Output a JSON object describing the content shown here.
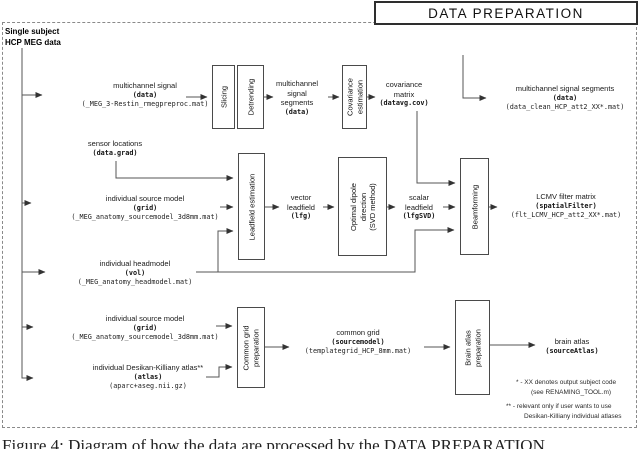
{
  "title": "DATA PREPARATION",
  "subject_label": "Single subject\nHCP MEG data",
  "caption": "Figure 4: Diagram of how the data are processed by the DATA PREPARATION",
  "boxes": {
    "slicing": "Slicing",
    "detrending": "Detrending",
    "covariance_estimation": "Covariance\nestimation",
    "leadfield_estimation": "Leadfield estimation",
    "optimal_dipole": "Optimal dipole\ndirection\n(SVD method)",
    "beamforming": "Beamforming",
    "common_grid_preparation": "Common grid\npreparation",
    "brain_atlas_preparation": "Brain atlas\npreparation"
  },
  "labels": {
    "multichannel_signal": [
      "multichannel signal",
      "(data)",
      "(_MEG_3-Restin_rmegpreproc.mat)"
    ],
    "mc_signal_segments": [
      "multichannel",
      "signal",
      "segments",
      "(data)"
    ],
    "covariance_matrix": [
      "covariance",
      "matrix",
      "(datavg.cov)"
    ],
    "mc_signal_segments_out": [
      "multichannel signal segments",
      "(data)",
      "(data_clean_HCP_att2_XX*.mat)"
    ],
    "sensor_locations": [
      "sensor locations",
      "(data.grad)"
    ],
    "source_model_1": [
      "individual source model",
      "(grid)",
      "(_MEG_anatomy_sourcemodel_3d8mm.mat)"
    ],
    "vector_leadfield": [
      "vector",
      "leadfield",
      "(lfg)"
    ],
    "scalar_leadfield": [
      "scalar",
      "leadfield",
      "(lfgSVD)"
    ],
    "lcmv_filter": [
      "LCMV filter matrix",
      "(spatialFilter)",
      "(flt_LCMV_HCP_att2_XX*.mat)"
    ],
    "headmodel": [
      "individual headmodel",
      "(vol)",
      "(_MEG_anatomy_headmodel.mat)"
    ],
    "source_model_2": [
      "individual source model",
      "(grid)",
      "(_MEG_anatomy_sourcemodel_3d8mm.mat)"
    ],
    "atlas_in": [
      "individual Desikan-Killiany atlas**",
      "(atlas)",
      "(aparc+aseg.nii.gz)"
    ],
    "common_grid_out": [
      "common grid",
      "(sourcemodel)",
      "(templategrid_HCP_8mm.mat)"
    ],
    "brain_atlas_out": [
      "brain atlas",
      "(sourceAtlas)"
    ]
  },
  "footnotes": {
    "f1_line1": "* - XX denotes output subject code",
    "f1_line2": "(see RENAMING_TOOL.m)",
    "f2_line1": "** - relevant only if user wants to use",
    "f2_line2": "Desikan-Killiany individual atlases"
  },
  "colors": {
    "line": "#555555",
    "border": "#8a8a8a",
    "text": "#1a1a1a"
  }
}
